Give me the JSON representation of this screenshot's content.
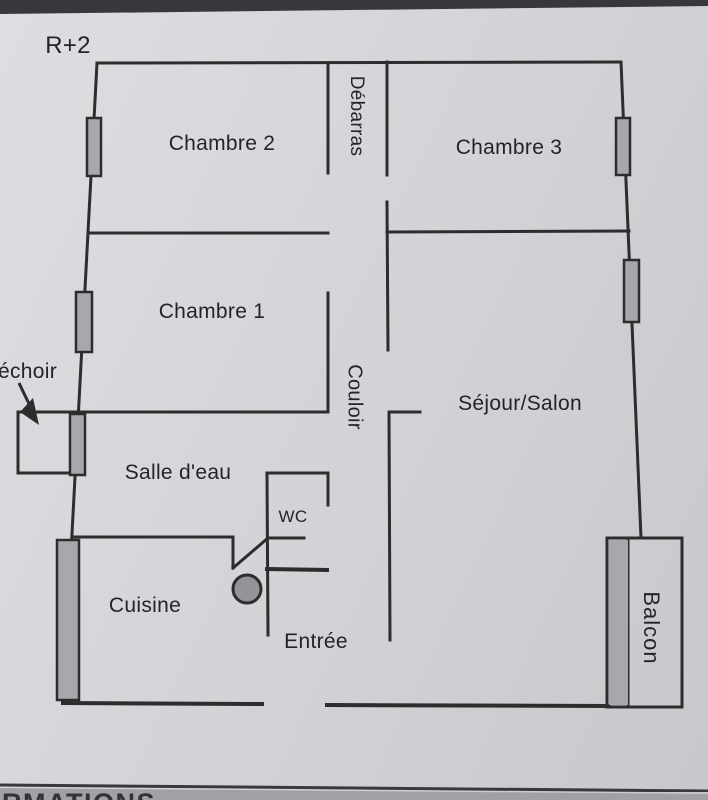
{
  "header": {
    "floor_label": "R+2"
  },
  "rooms": {
    "chambre2": "Chambre 2",
    "debarras": "Débarras",
    "chambre3": "Chambre 3",
    "chambre1": "Chambre 1",
    "couloir": "Couloir",
    "sejour_salon": "Séjour/Salon",
    "sechoir_partial": "échoir",
    "salle_eau": "Salle d'eau",
    "wc": "WC",
    "cuisine": "Cuisine",
    "entree": "Entrée",
    "balcon": "Balcon"
  },
  "footer": {
    "partial_text": "RMATIONS"
  },
  "colors": {
    "paper": "#d4d5d8",
    "wall": "#2d2d2e",
    "window_fill": "#a6a8ab",
    "circle_fill": "#929497",
    "top_band": "#37383b",
    "footer_band": "#a0a1a4",
    "text": "#232427"
  }
}
